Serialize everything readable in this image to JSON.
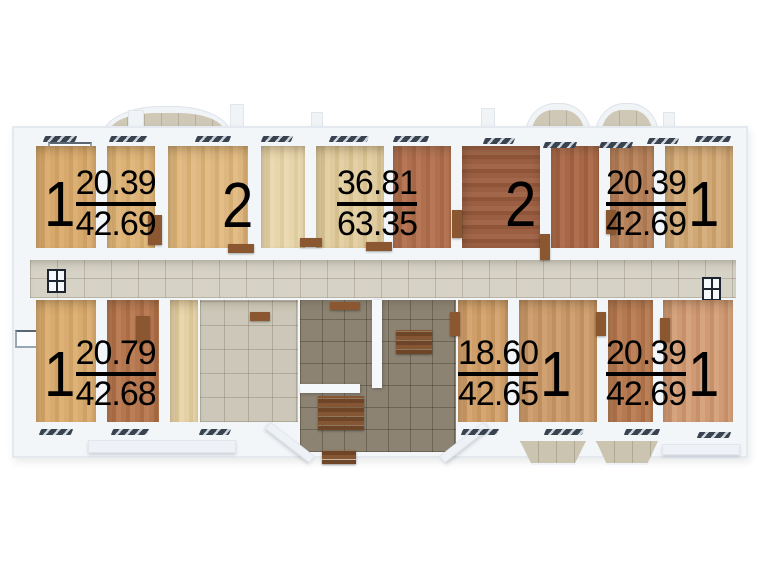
{
  "plan": {
    "title": "apartment-floor-plan",
    "units": [
      {
        "id": "unit-top-left",
        "rooms_label": "1",
        "area_living": "20.39",
        "area_total": "42.69"
      },
      {
        "id": "unit-top-left-2",
        "rooms_label": "2"
      },
      {
        "id": "unit-top-center",
        "area_living": "36.81",
        "area_total": "63.35"
      },
      {
        "id": "unit-top-right-2",
        "rooms_label": "2"
      },
      {
        "id": "unit-top-right",
        "rooms_label": "1",
        "area_living": "20.39",
        "area_total": "42.69"
      },
      {
        "id": "unit-bottom-left",
        "rooms_label": "1",
        "area_living": "20.79",
        "area_total": "42.68"
      },
      {
        "id": "unit-bottom-center",
        "rooms_label": "1",
        "area_living": "18.60",
        "area_total": "42.65"
      },
      {
        "id": "unit-bottom-right",
        "rooms_label": "1",
        "area_living": "20.39",
        "area_total": "42.69"
      }
    ],
    "icons": {
      "corridor_window_left": "window-grid-icon",
      "corridor_window_right": "window-grid-icon",
      "glazing": "window-glazing-icon"
    },
    "palette": {
      "background": "#ffffff",
      "wall": "#f3f6f9",
      "wall_shadow": "#c9d2dc",
      "corridor_tile": "#d6d2c6",
      "lobby_tile": "#ccc7b8",
      "stair_tile": "#8d8372",
      "balcony_tile": "#cbc4b1",
      "wood_light_oak": "#d7a96d",
      "wood_pale": "#e0cda1",
      "wood_red_brown": "#9a5e42",
      "wood_pink_tan": "#cf9a74",
      "door_wood": "#8a5731",
      "glazing_dark": "#39434f",
      "label_text": "#000000"
    }
  }
}
